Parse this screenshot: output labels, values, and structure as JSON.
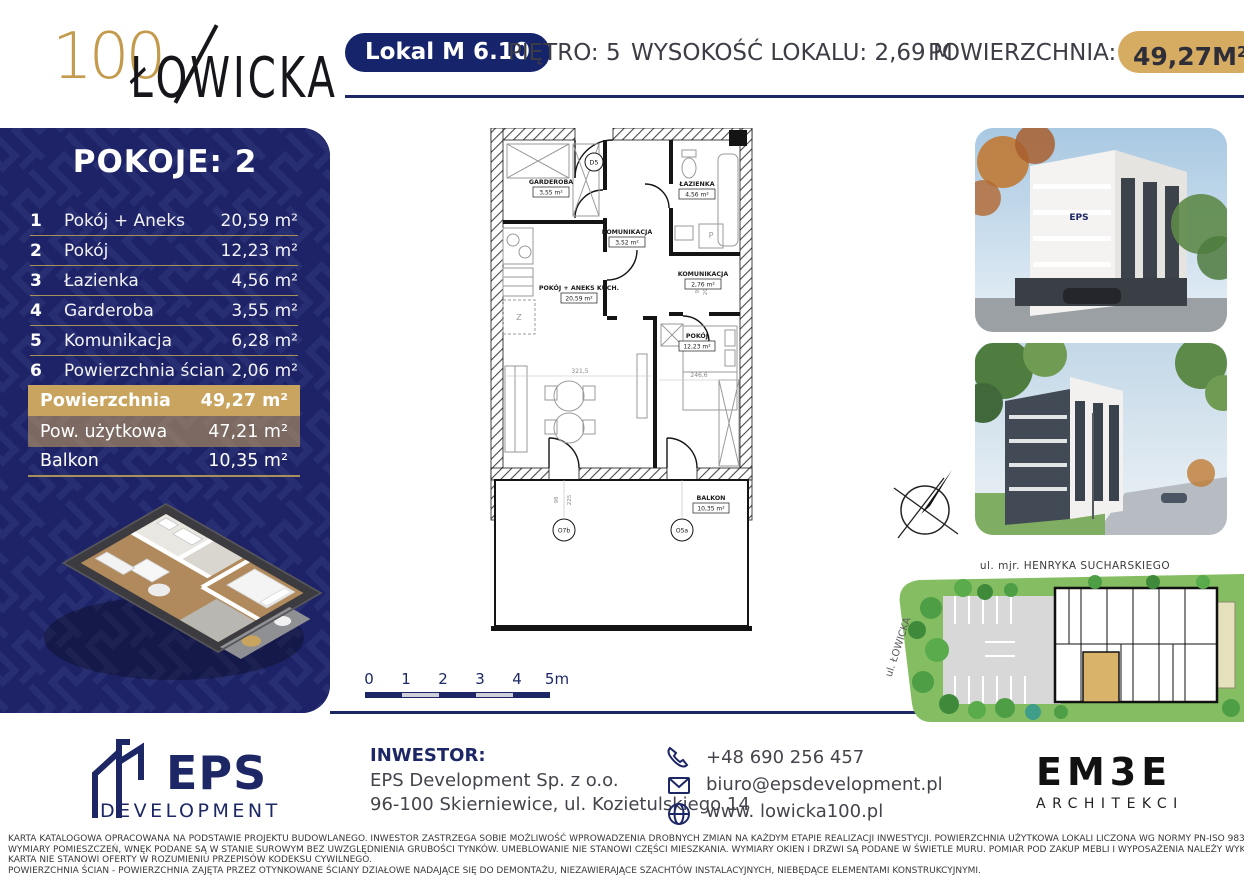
{
  "colors": {
    "navy": "#1d2366",
    "gold": "#c9a45e",
    "gold_badge": "#d6ac62",
    "accent_line": "#a8905a"
  },
  "header": {
    "logo_number": "100",
    "logo_name": "ŁOWICKA",
    "unit_badge": "Lokal M 6.10",
    "floor": "PIĘTRO: 5",
    "height": "WYSOKOŚĆ LOKALU: 2,69 M",
    "area_label": "POWIERZCHNIA:",
    "area_value": "49,27M",
    "area_sup": "2"
  },
  "sidebar": {
    "title": "POKOJE: 2",
    "rooms": [
      {
        "no": "1",
        "name": "Pokój + Aneks",
        "area": "20,59 m²"
      },
      {
        "no": "2",
        "name": "Pokój",
        "area": "12,23 m²"
      },
      {
        "no": "3",
        "name": "Łazienka",
        "area": "4,56 m²"
      },
      {
        "no": "4",
        "name": "Garderoba",
        "area": "3,55 m²"
      },
      {
        "no": "5",
        "name": "Komunikacja",
        "area": "6,28 m²"
      },
      {
        "no": "6",
        "name": "Powierzchnia ścian",
        "area": "2,06 m²"
      }
    ],
    "summary": [
      {
        "name": "Powierzchnia",
        "area": "49,27 m²"
      },
      {
        "name": "Pow. użytkowa",
        "area": "47,21 m²"
      },
      {
        "name": "Balkon",
        "area": "10,35 m²"
      }
    ]
  },
  "plan": {
    "rooms": [
      {
        "name": "GARDEROBA",
        "area": "3,55 m²"
      },
      {
        "name": "KOMUNIKACJA",
        "area": "3,52 m²"
      },
      {
        "name": "ŁAZIENKA",
        "area": "4,56 m²"
      },
      {
        "name": "KOMUNIKACJA",
        "area": "2,76 m²"
      },
      {
        "name": "POKÓJ + ANEKS KUCH.",
        "area": "20,59 m²"
      },
      {
        "name": "POKÓJ",
        "area": "12,23 m²"
      },
      {
        "name": "BALKON",
        "area": "10,35 m²"
      }
    ],
    "door_label": "D5",
    "window_labels": [
      "O7b",
      "O5a"
    ],
    "washer_symbol": "P",
    "sink_symbol": "Z",
    "dimensions": [
      "92",
      "208",
      "321,5",
      "246,6",
      "98",
      "225"
    ],
    "scale_ticks": [
      "0",
      "1",
      "2",
      "3",
      "4",
      "5m"
    ]
  },
  "siteplan": {
    "street_top": "ul. mjr. HENRYKA SUCHARSKIEGO",
    "street_left": "ul. ŁOWICKA"
  },
  "footer": {
    "eps": {
      "word": "EPS",
      "sub": "DEVELOPMENT"
    },
    "investor_label": "INWESTOR:",
    "investor_name": "EPS Development Sp. z o.o.",
    "investor_address": "96-100 Skierniewice, ul. Kozietulskiego 14",
    "contact": {
      "phone": "+48 690 256 457",
      "email": "biuro@epsdevelopment.pl",
      "website": "www. lowicka100.pl"
    },
    "embe": {
      "word": "EM3E",
      "sub": "ARCHITEKCI"
    }
  },
  "legal": [
    "KARTA KATALOGOWA OPRACOWANA NA PODSTAWIE PROJEKTU BUDOWLANEGO. INWESTOR ZASTRZEGA SOBIE MOŻLIWOŚĆ WPROWADZENIA DROBNYCH ZMIAN NA KAŻDYM ETAPIE REALIZACJI INWESTYCJI. POWIERZCHNIA UŻYTKOWA LOKALI LICZONA WG NORMY PN-ISO 9836:2022-07.",
    "WYMIARY POMIESZCZEŃ, WNĘK PODANE SĄ W STANIE SUROWYM BEZ UWZGLĘDNIENIA GRUBOŚCI TYNKÓW. UMEBLOWANIE NIE STANOWI CZĘŚCI MIESZKANIA. WYMIARY OKIEN I DRZWI SĄ PODANE W ŚWIETLE MURU. POMIAR POD ZAKUP MEBLI I WYPOSAŻENIA NALEŻY WYKONAĆ Z NATURY.",
    "KARTA NIE STANOWI OFERTY W ROZUMIENIU PRZEPISÓW KODEKSU CYWILNEGO.",
    "POWIERZCHNIA ŚCIAN - POWIERZCHNIA ZAJĘTA PRZEZ OTYNKOWANE ŚCIANY DZIAŁOWE NADAJĄCE SIĘ DO DEMONTAŻU, NIEZAWIERAJĄCE SZACHTÓW INSTALACYJNYCH, NIEBĘDĄCE ELEMENTAMI KONSTRUKCYJNYMI."
  ]
}
